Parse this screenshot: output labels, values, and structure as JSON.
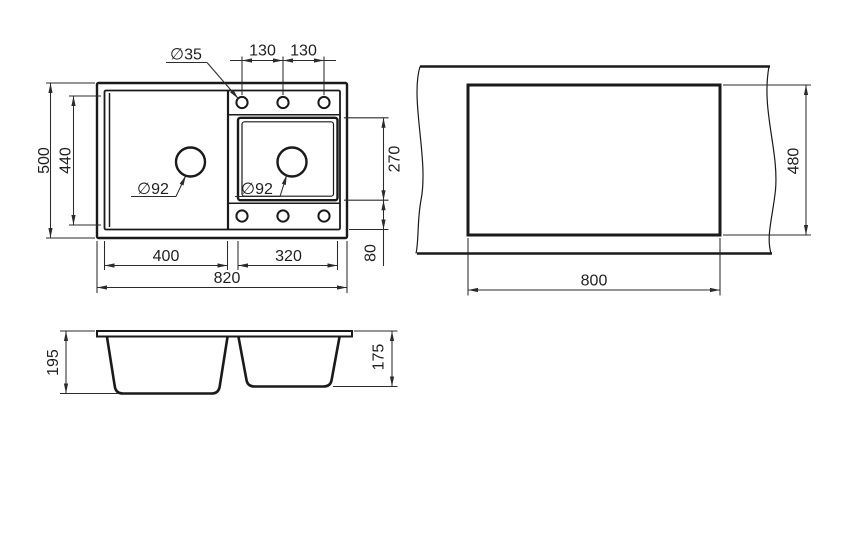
{
  "drawing_type": "kitchen sink technical dimension drawing",
  "colors": {
    "outline": "#1a1a1a",
    "dimension_lines": "#2b2b2b",
    "background": "#ffffff"
  },
  "plan_view": {
    "dim_overall_length": "820",
    "dim_overall_depth": "500",
    "dim_inner_depth": "440",
    "dim_left_bowl_length": "400",
    "dim_right_bowl_length": "320",
    "dim_right_bowl_depth": "270",
    "dim_rear_offset": "80",
    "dim_tap_hole_diameter": "∅35",
    "dim_tap_hole_spacing_a": "130",
    "dim_tap_hole_spacing_b": "130",
    "dim_drain_left_diameter": "∅92",
    "dim_drain_right_diameter": "∅92"
  },
  "cutout_view": {
    "dim_cutout_length": "800",
    "dim_cutout_depth": "480"
  },
  "section_view": {
    "dim_left_bowl_depth": "195",
    "dim_right_bowl_depth": "175"
  }
}
